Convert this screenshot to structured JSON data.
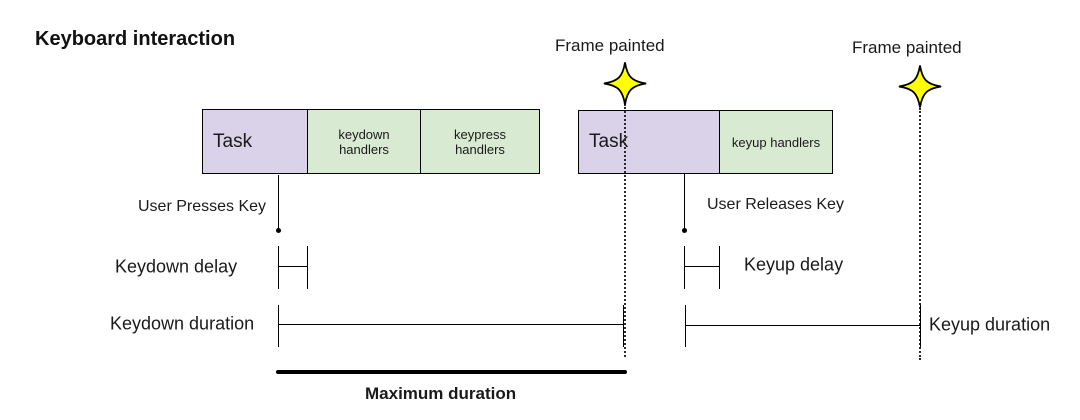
{
  "title": "Keyboard interaction",
  "colors": {
    "task_fill": "#d9d2e9",
    "handler_fill": "#d9ead3",
    "star_fill": "#ffff00",
    "line": "#000000"
  },
  "frame_markers": [
    {
      "label": "Frame painted"
    },
    {
      "label": "Frame painted"
    }
  ],
  "task_groups": [
    {
      "name": "keydown task",
      "segments": [
        {
          "label": "Task",
          "type": "task"
        },
        {
          "label": "keydown handlers",
          "type": "handler"
        },
        {
          "label": "keypress handlers",
          "type": "handler"
        }
      ]
    },
    {
      "name": "keyup task",
      "segments": [
        {
          "label": "Task",
          "type": "task"
        },
        {
          "label": "keyup handlers",
          "type": "handler"
        }
      ]
    }
  ],
  "annotations": {
    "user_presses": "User Presses Key",
    "keydown_delay": "Keydown delay",
    "keydown_duration": "Keydown duration",
    "user_releases": "User Releases Key",
    "keyup_delay": "Keyup delay",
    "keyup_duration": "Keyup duration",
    "maximum_duration": "Maximum duration"
  }
}
